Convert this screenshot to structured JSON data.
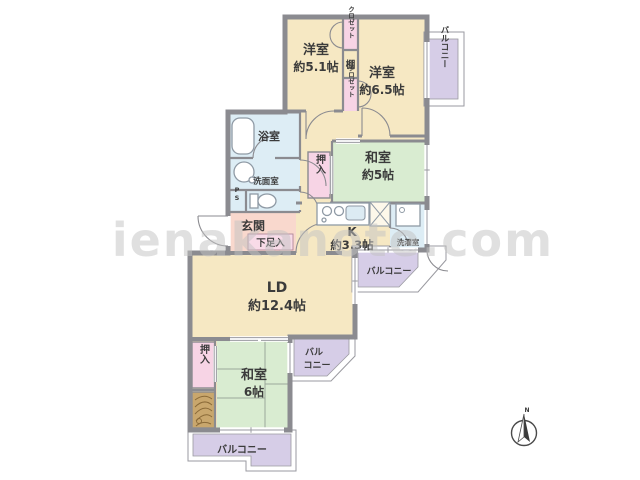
{
  "floorplan": {
    "rooms": {
      "western1": {
        "name": "洋室",
        "size": "約5.1帖"
      },
      "western2": {
        "name": "洋室",
        "size": "約6.5帖"
      },
      "japanese1": {
        "name": "和室",
        "size": "約5帖"
      },
      "japanese2": {
        "name": "和室",
        "size": "6帖"
      },
      "living_dining": {
        "name": "LD",
        "size": "約12.4帖"
      },
      "kitchen": {
        "name": "K",
        "size": "約3.3帖"
      }
    },
    "labels": {
      "genkan": "玄関",
      "shoe_box": "下足入",
      "bath": "浴室",
      "washroom": "洗面室",
      "toilet_ps": "PS",
      "laundry": "洗濯室",
      "closet_upper": "クロゼット",
      "closet_lower": "クロゼット",
      "shelf": "棚",
      "oshiire_1": "押入",
      "oshiire_2": "押入",
      "balcony_top": "バルコニー",
      "balcony_kitchen": "バルコニー",
      "balcony_mid_line1": "バル",
      "balcony_mid_line2": "コニー",
      "balcony_bottom": "バルコニー"
    },
    "compass": {
      "north": "N"
    },
    "watermark": "ienakanote.com",
    "colors": {
      "floor": "#f6e8c3",
      "tatami": "#d9ecd1",
      "closet_pink": "#f7d4e5",
      "entrance": "#f9d8cd",
      "wet_area": "#ddedf5",
      "balcony": "#d6cde7",
      "wall": "#8b8b90",
      "tokonoma": "#c9a76d"
    }
  }
}
